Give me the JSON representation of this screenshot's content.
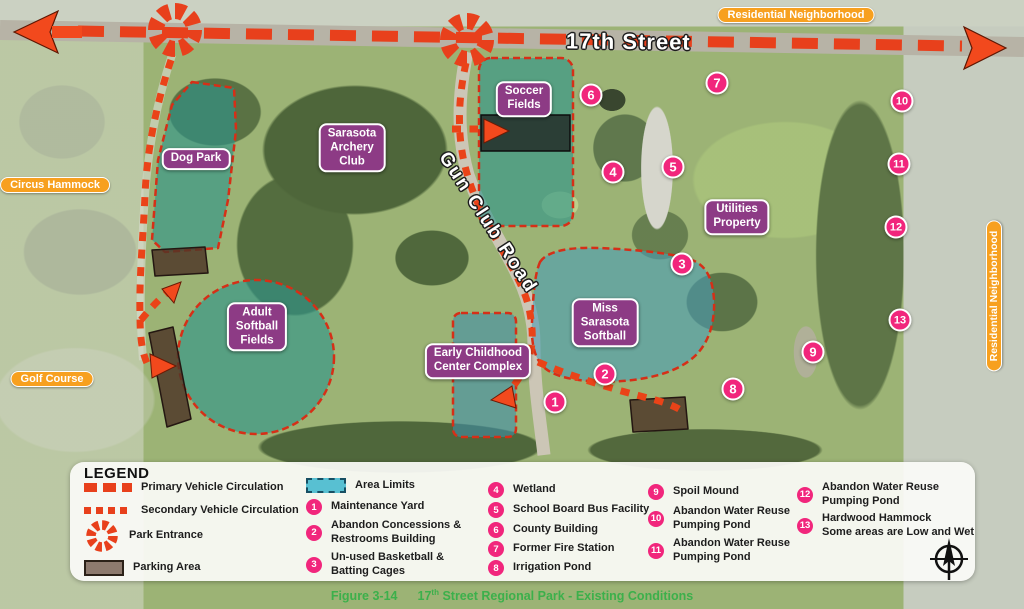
{
  "map": {
    "roads": {
      "street_17th": "17th Street",
      "gun_club_road": "Gun Club Road"
    },
    "context_labels": {
      "residential_top": "Residential Neighborhood",
      "residential_right": "Residential Neighborhood",
      "circus_hammock": "Circus Hammock",
      "golf_course": "Golf Course"
    },
    "facilities": {
      "dog_park": "Dog Park",
      "archery_club": "Sarasota\nArchery\nClub",
      "soccer_fields": "Soccer\nFields",
      "adult_softball": "Adult\nSoftball\nFields",
      "miss_sarasota": "Miss\nSarasota\nSoftball",
      "early_childhood": "Early Childhood\nCenter Complex",
      "utilities": "Utilities\nProperty"
    }
  },
  "legend": {
    "title": "LEGEND",
    "line_items": [
      {
        "label": "Primary Vehicle Circulation"
      },
      {
        "label": "Secondary Vehicle Circulation"
      },
      {
        "label": "Park Entrance"
      },
      {
        "label": "Parking Area"
      },
      {
        "label": "Area Limits"
      }
    ],
    "numbered_items": [
      {
        "number": "1",
        "label": "Maintenance Yard"
      },
      {
        "number": "2",
        "label": "Abandon Concessions & Restrooms Building"
      },
      {
        "number": "3",
        "label": "Un-used Basketball & Batting Cages"
      },
      {
        "number": "4",
        "label": "Wetland"
      },
      {
        "number": "5",
        "label": "School Board Bus Facility"
      },
      {
        "number": "6",
        "label": "County Building"
      },
      {
        "number": "7",
        "label": "Former Fire Station"
      },
      {
        "number": "8",
        "label": "Irrigation Pond"
      },
      {
        "number": "9",
        "label": "Spoil Mound"
      },
      {
        "number": "10",
        "label": "Abandon Water Reuse\nPumping Pond"
      },
      {
        "number": "11",
        "label": "Abandon Water Reuse\nPumping Pond"
      },
      {
        "number": "12",
        "label": "Abandon Water Reuse\nPumping Pond"
      },
      {
        "number": "13",
        "label": "Hardwood Hammock\nSome areas are Low and Wet"
      }
    ]
  },
  "caption": {
    "figure": "Figure 3-14",
    "title_pre": "17",
    "title_sup": "th",
    "title_post": " Street Regional Park - Existing Conditions"
  },
  "colors": {
    "route_red": "#e8401c",
    "facility_label_bg": "#8d3b85",
    "marker_pink": "#f1267c",
    "context_label_orange": "#f7a01f",
    "area_limit_teal": "#2e958c",
    "caption_green": "#3cb04b"
  }
}
